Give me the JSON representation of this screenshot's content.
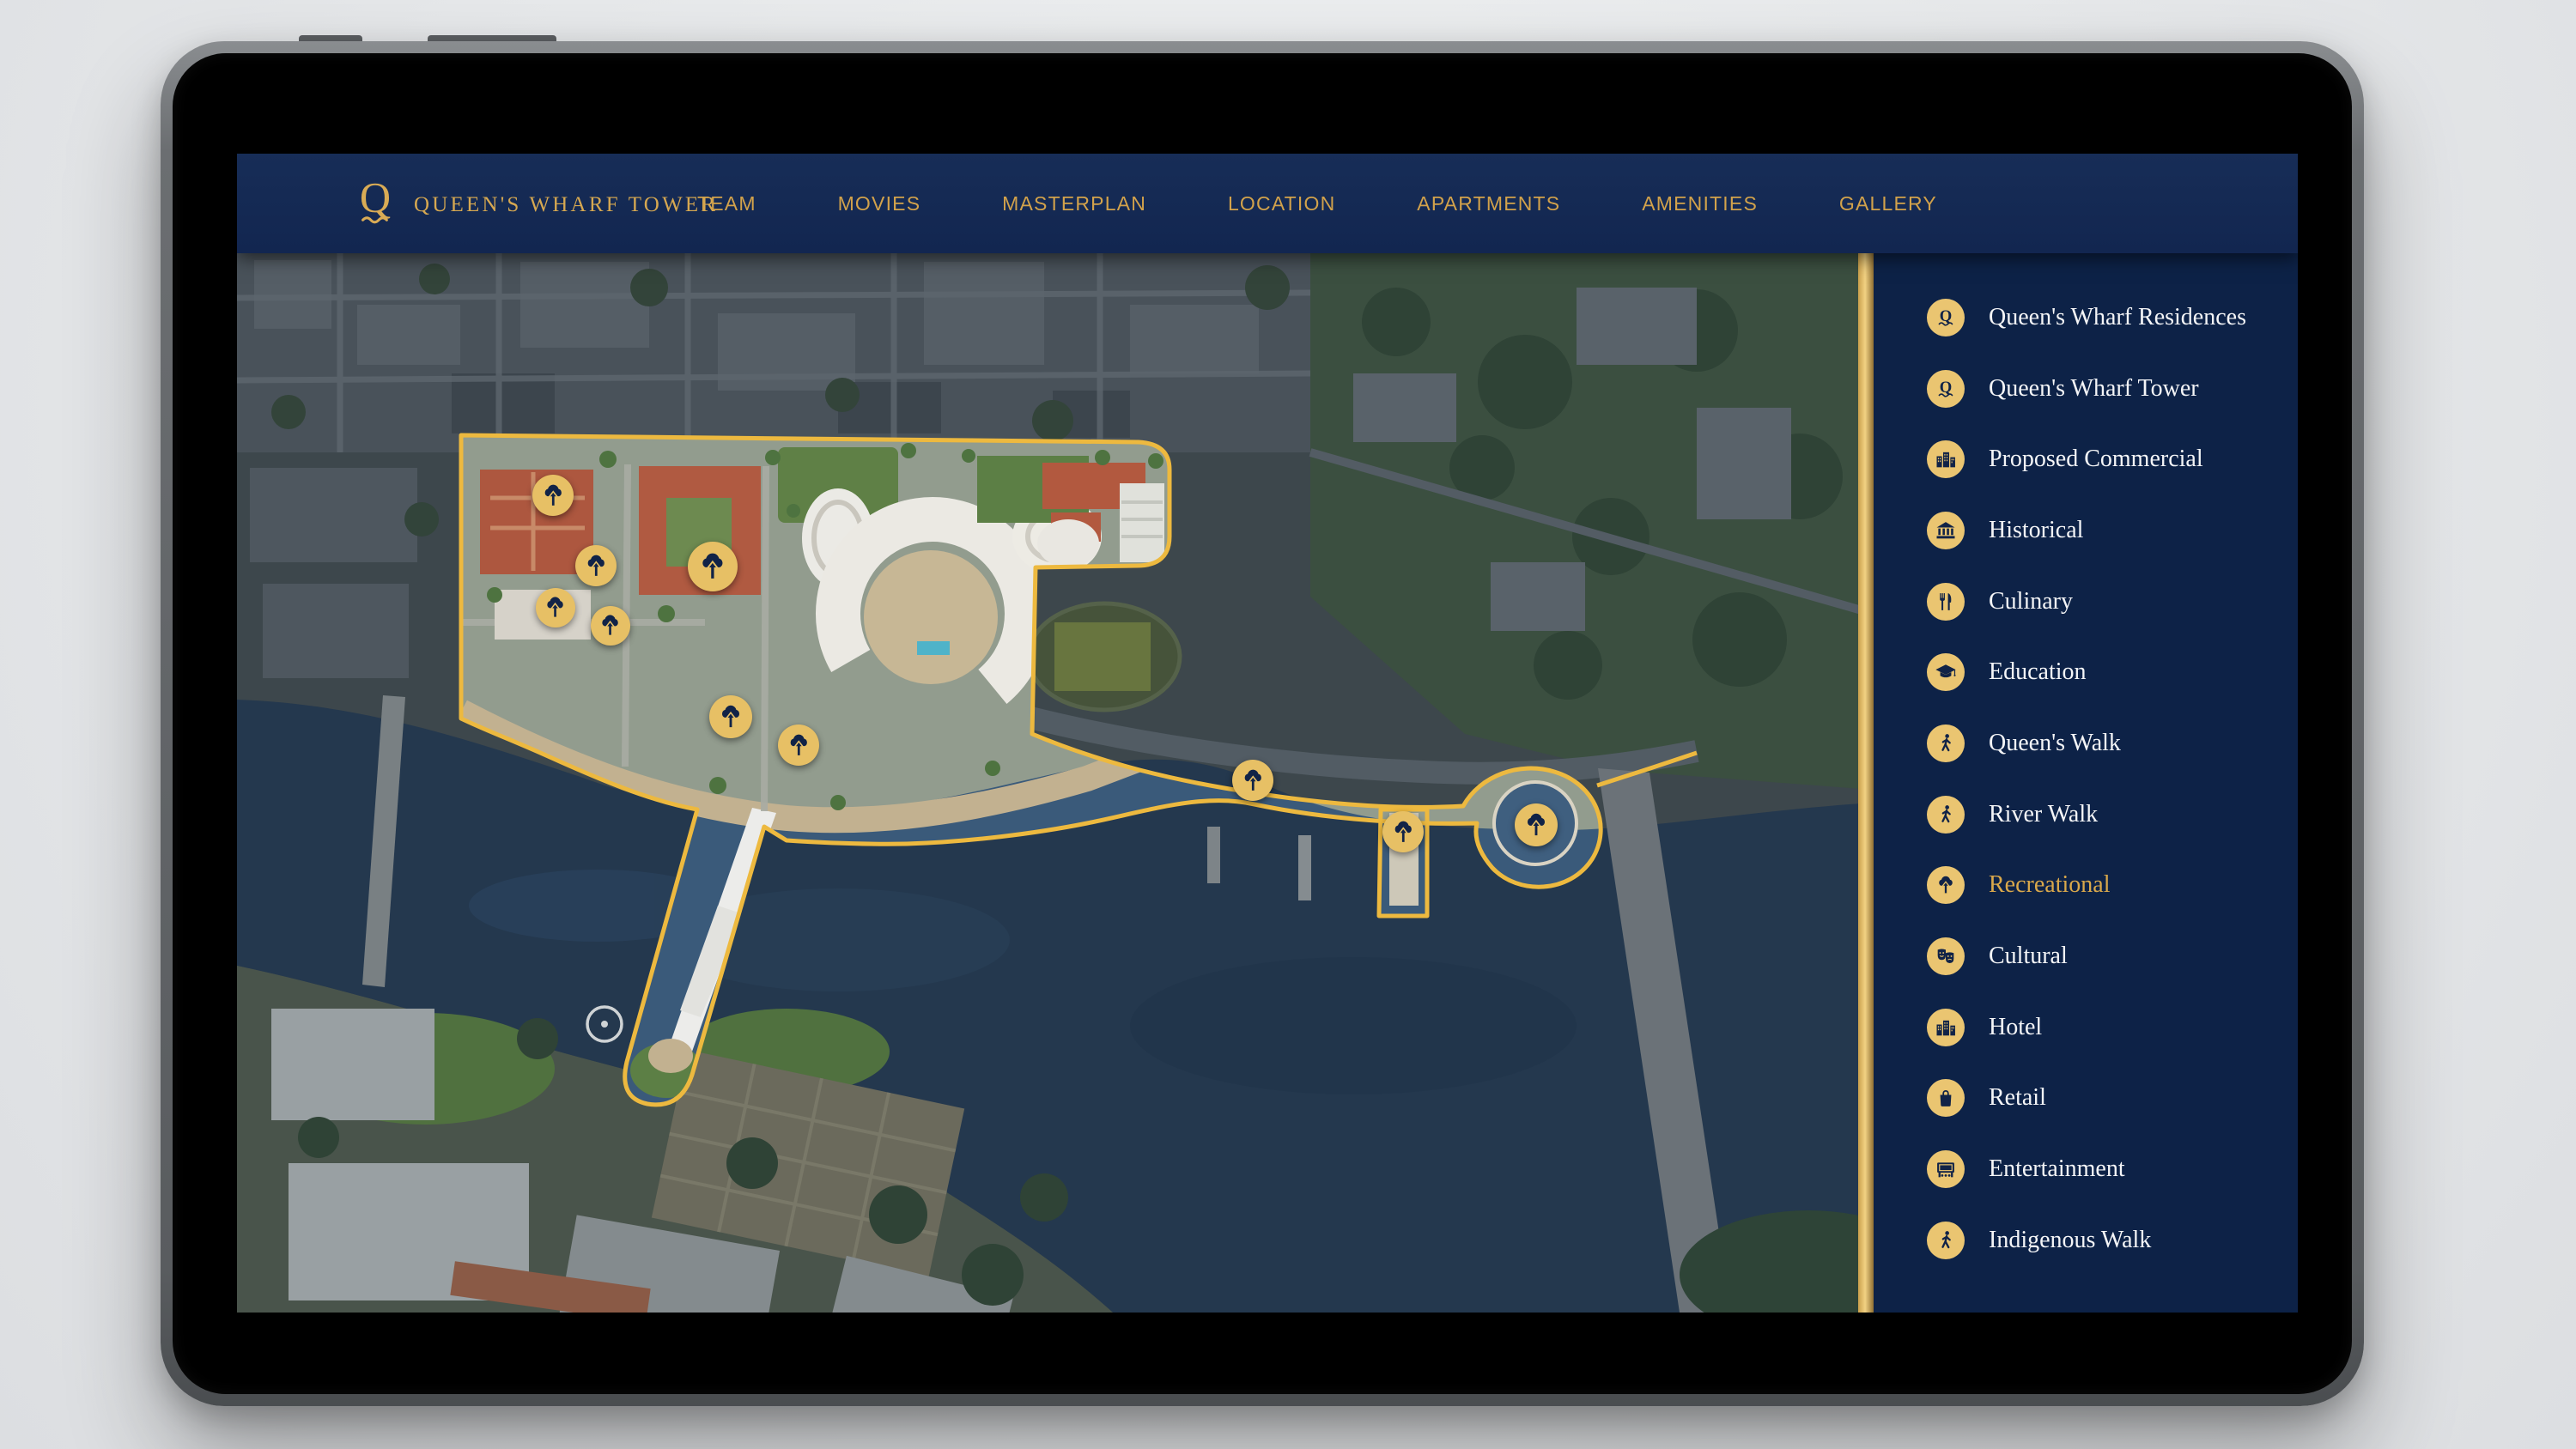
{
  "device": {
    "type": "tablet mockup"
  },
  "header": {
    "logo": {
      "mark": "Q",
      "title": "QUEEN'S WHARF TOWER"
    },
    "nav": [
      {
        "label": "TEAM"
      },
      {
        "label": "MOVIES"
      },
      {
        "label": "MASTERPLAN"
      },
      {
        "label": "LOCATION"
      },
      {
        "label": "APARTMENTS"
      },
      {
        "label": "AMENITIES"
      },
      {
        "label": "GALLERY"
      }
    ]
  },
  "legend": {
    "items": [
      {
        "label": "Queen's Wharf Residences",
        "icon": "q-crest-icon",
        "active": false
      },
      {
        "label": "Queen's Wharf Tower",
        "icon": "q-crest-icon",
        "active": false
      },
      {
        "label": "Proposed Commercial",
        "icon": "buildings-icon",
        "active": false
      },
      {
        "label": "Historical",
        "icon": "classical-building-icon",
        "active": false
      },
      {
        "label": "Culinary",
        "icon": "cutlery-icon",
        "active": false
      },
      {
        "label": "Education",
        "icon": "graduation-cap-icon",
        "active": false
      },
      {
        "label": "Queen's Walk",
        "icon": "walking-person-icon",
        "active": false
      },
      {
        "label": "River Walk",
        "icon": "walking-person-icon",
        "active": false
      },
      {
        "label": "Recreational",
        "icon": "tree-up-icon",
        "active": true
      },
      {
        "label": "Cultural",
        "icon": "theatre-masks-icon",
        "active": false
      },
      {
        "label": "Hotel",
        "icon": "buildings-icon",
        "active": false
      },
      {
        "label": "Retail",
        "icon": "shopping-bag-icon",
        "active": false
      },
      {
        "label": "Entertainment",
        "icon": "cinema-marquee-icon",
        "active": false
      },
      {
        "label": "Indigenous Walk",
        "icon": "walking-person-icon",
        "active": false
      }
    ]
  },
  "map": {
    "markers": {
      "icon": "tree-up-icon",
      "count": 10
    },
    "outline_color": "#edb93f",
    "marker_color": "#e7c065"
  },
  "colors": {
    "navy_header": "#13294f",
    "navy_sidebar": "#0d2247",
    "gold_text": "#d2a24b",
    "gold_outline": "#edb93f",
    "icon_gold": "#eac571",
    "text_white": "#f4f5f7"
  }
}
